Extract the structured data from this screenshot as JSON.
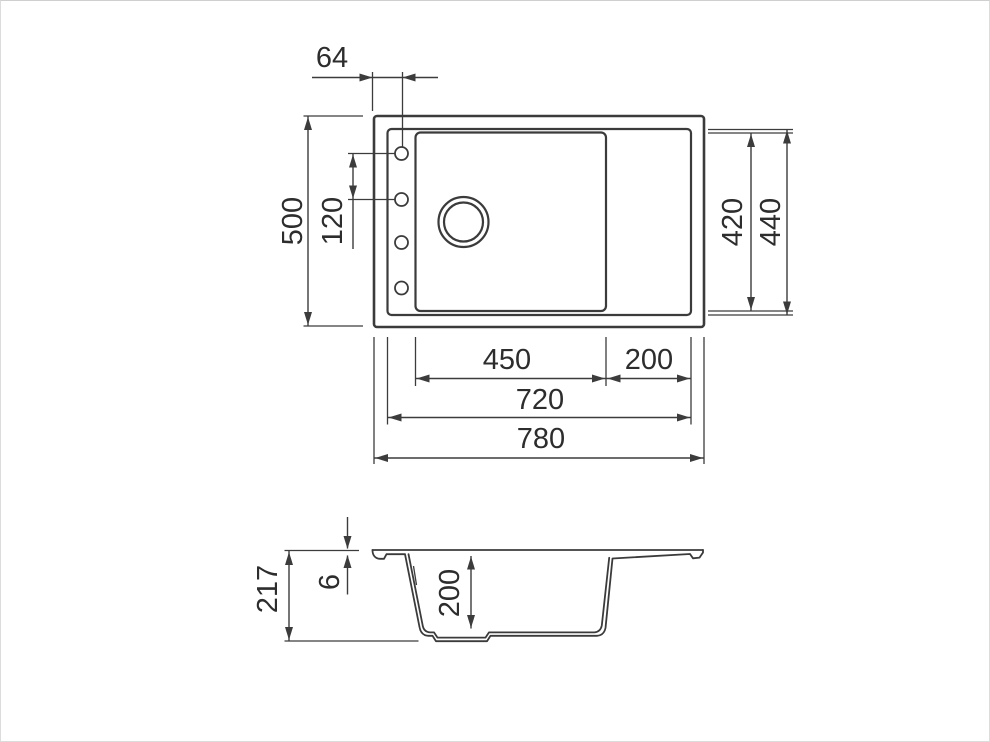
{
  "drawing": {
    "kind": "sink-technical-drawing",
    "colors": {
      "line": "#3b3b3b",
      "text": "#2d2d2d",
      "background": "#ffffff",
      "frame": "#dcdcdc"
    },
    "top_view": {
      "overall_width": "780",
      "rim_width": "720",
      "bowl_width": "450",
      "drainboard_width": "200",
      "overall_depth": "500",
      "rim_depth": "440",
      "bowl_depth": "420",
      "tap_hole_offset": "64",
      "tap_hole_spacing": "120"
    },
    "side_view": {
      "overall_height": "217",
      "rim_thickness": "6",
      "bowl_inner_depth": "200"
    }
  }
}
